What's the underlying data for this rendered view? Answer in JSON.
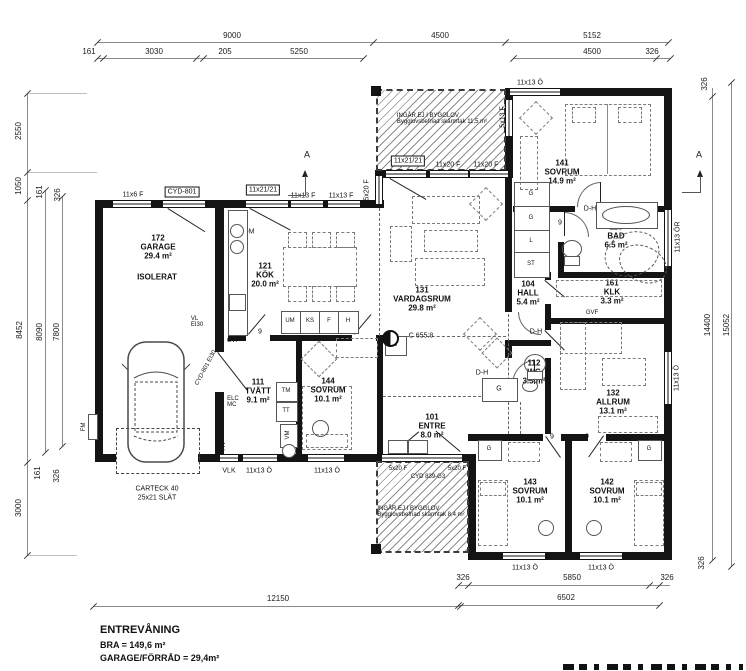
{
  "footer": {
    "title": "ENTREVÅNING",
    "line1": "BRA = 149,6 m²",
    "line2": "GARAGE/FÖRRÅD = 29,4m²"
  },
  "rooms": {
    "garage": {
      "num": "172",
      "name": "GARAGE",
      "area": "29.4 m²",
      "note": "ISOLERAT"
    },
    "kok": {
      "num": "121",
      "name": "KÖK",
      "area": "20.0 m²"
    },
    "vardagsrum": {
      "num": "131",
      "name": "VARDAGSRUM",
      "area": "29.8 m²"
    },
    "sovrum141": {
      "num": "141",
      "name": "SOVRUM",
      "area": "14.9 m²"
    },
    "bad": {
      "num": "115",
      "name": "BAD",
      "area": "6.5 m²"
    },
    "hall": {
      "num": "104",
      "name": "HALL",
      "area": "5.4 m²"
    },
    "klk": {
      "num": "161",
      "name": "KLK",
      "area": "3.3 m²"
    },
    "tvatt": {
      "num": "111",
      "name": "TVÄTT",
      "area": "9.1 m²"
    },
    "sovrum144": {
      "num": "144",
      "name": "SOVRUM",
      "area": "10.1 m²"
    },
    "entre": {
      "num": "101",
      "name": "ENTRE",
      "area": "8.0 m²"
    },
    "wc": {
      "num": "112",
      "name": "WC",
      "area": "3.3 m²"
    },
    "allrum": {
      "num": "132",
      "name": "ALLRUM",
      "area": "13.1 m²"
    },
    "sovrum143": {
      "num": "143",
      "name": "SOVRUM",
      "area": "10.1 m²"
    },
    "sovrum142": {
      "num": "142",
      "name": "SOVRUM",
      "area": "10.1 m²"
    }
  },
  "canopy_top": {
    "l1": "INGÅR EJ I BYGGLOV",
    "l2": "Bygglovsbefriad skärmtak 11,5 m²"
  },
  "canopy_bottom": {
    "l1": "INGÅR EJ I BYGGLOV",
    "l2": "Bygglovsbefriad skärmtak 8,4 m²"
  },
  "openings": {
    "o1": "11x6 F",
    "o2": "CYD-801",
    "o3": "11x21/21",
    "o4": "11x13 F",
    "o5": "11x13 F",
    "o6": "5x20 F",
    "o7": "11x21/21",
    "o8": "11x20 F",
    "o9": "11x20 F",
    "o10": "5x13 F",
    "o11": "11x13 Ö",
    "o12": "11x13 ÖR",
    "o13": "11x13 Ö",
    "o14": "VLK",
    "o15": "11x13 Ö",
    "o16": "11x13 Ö",
    "o17": "5x20 F",
    "o18": "CYD 839-G3",
    "o19": "5x20 F",
    "o20": "11x13 Ö",
    "o21": "11x13 Ö",
    "o22": "CARTECK 40",
    "o23": "25x21 SLÄT"
  },
  "fixtures": {
    "dm": "DM",
    "um": "UM",
    "ks": "KS",
    "f": "F",
    "h": "H",
    "g": "G",
    "l": "L",
    "st": "ST",
    "tm": "TM",
    "tt": "TT",
    "vm": "VM",
    "elc": "ELC",
    "mc": "MC",
    "fv": "F/V",
    "fm": "FM",
    "gvf": "GVF",
    "vl": "VL",
    "ei30": "EI30",
    "fire_door": "CYD-801 EI30",
    "ref": "C 655:8",
    "dh": "D-H"
  },
  "door_codes": {
    "n9": "9",
    "n8": "8"
  },
  "dims": {
    "d9000": "9000",
    "d4500": "4500",
    "d5152": "5152",
    "d161": "161",
    "d3030": "3030",
    "d205": "205",
    "d5250": "5250",
    "d4500b": "4500",
    "d326": "326",
    "l2550": "2550",
    "l1050": "1050",
    "l161a": "161",
    "l326a": "326",
    "l8452": "8452",
    "l8090": "8090",
    "l7800": "7800",
    "l161b": "161",
    "l326b": "326",
    "l3000": "3000",
    "r326a": "326",
    "r14400": "14400",
    "r15052": "15052",
    "r326b": "326",
    "b12150": "12150",
    "b326a": "326",
    "b5850": "5850",
    "b326b": "326",
    "b6502": "6502"
  },
  "section_mark": "A"
}
